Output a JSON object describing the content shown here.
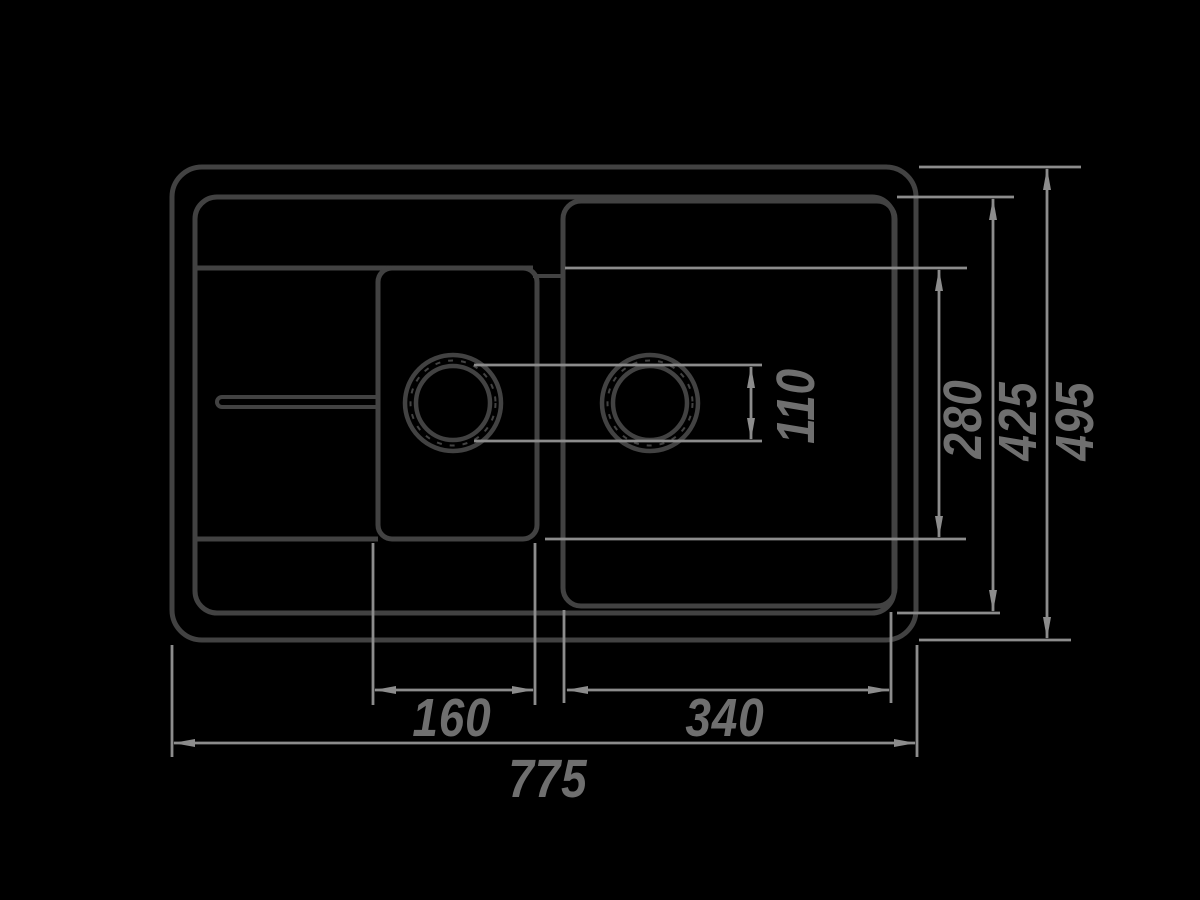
{
  "drawing": {
    "title": "sink-top-view-technical-drawing",
    "colors": {
      "background": "#000000",
      "outline": "#424242",
      "dimension_lines": "#8c8c8c",
      "dimension_text": "#6f6f6f"
    },
    "dimensions": {
      "overall_width": "775",
      "overall_depth": "495",
      "inner_rim_depth": "425",
      "bowl_depth": "280",
      "small_bowl_width": "160",
      "large_bowl_width": "340",
      "drain_hole_diameter": "110"
    }
  }
}
